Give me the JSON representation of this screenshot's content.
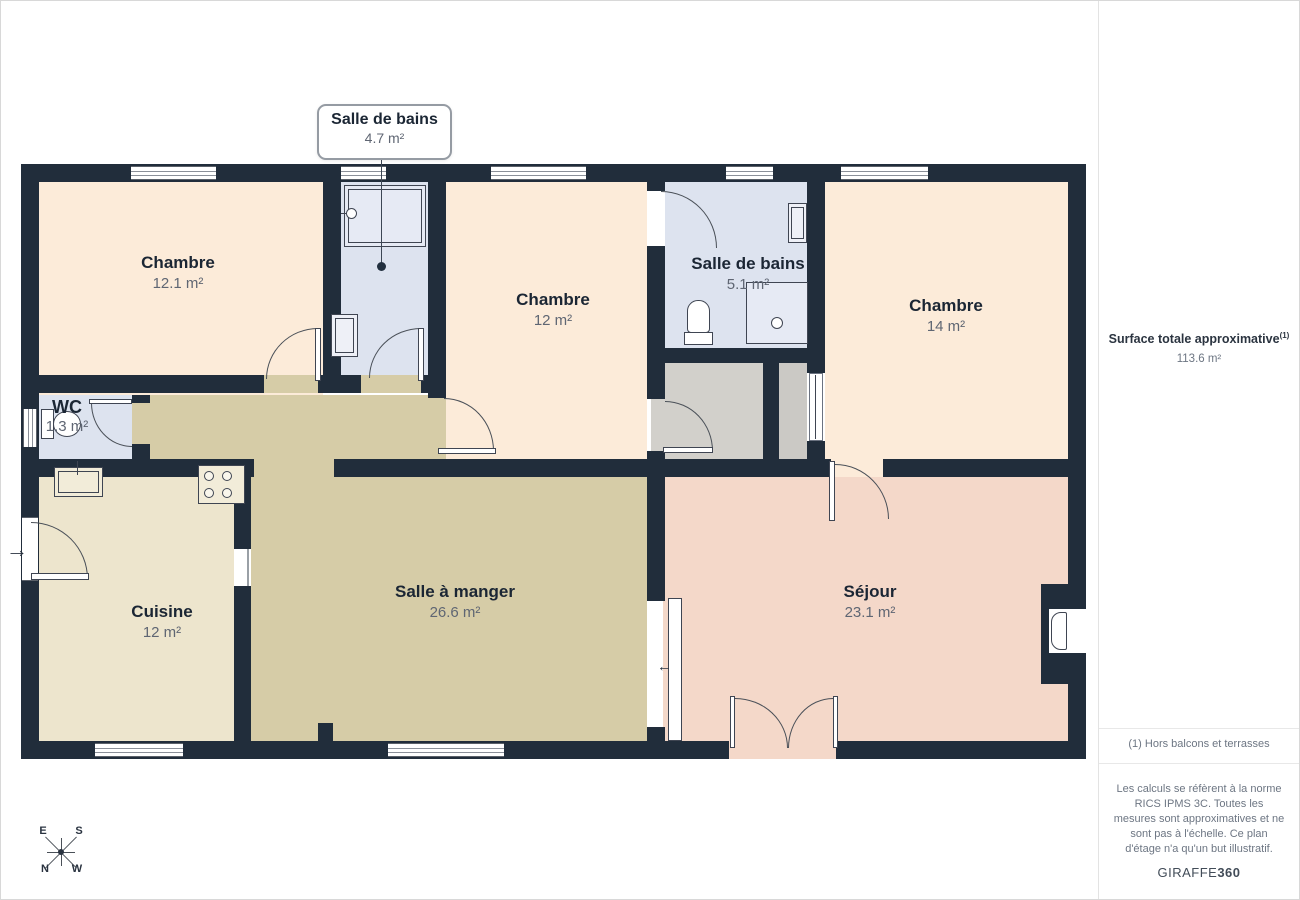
{
  "plan": {
    "callout": {
      "name": "Salle de bains",
      "area": "4.7 m²"
    },
    "rooms": [
      {
        "id": "chambre-1",
        "name": "Chambre",
        "area": "12.1 m²"
      },
      {
        "id": "chambre-2",
        "name": "Chambre",
        "area": "12 m²"
      },
      {
        "id": "salle-de-bains-2",
        "name": "Salle de bains",
        "area": "5.1 m²"
      },
      {
        "id": "chambre-3",
        "name": "Chambre",
        "area": "14 m²"
      },
      {
        "id": "wc",
        "name": "WC",
        "area": "1.3 m²"
      },
      {
        "id": "cuisine",
        "name": "Cuisine",
        "area": "12 m²"
      },
      {
        "id": "salle-a-manger",
        "name": "Salle à manger",
        "area": "26.6 m²"
      },
      {
        "id": "sejour",
        "name": "Séjour",
        "area": "23.1 m²"
      }
    ],
    "compass": {
      "e": "E",
      "s": "S",
      "n": "N",
      "w": "W"
    }
  },
  "sidebar": {
    "total_label": "Surface totale approximative",
    "total_marker": "(1)",
    "total_value": "113.6 m²",
    "footnote": "(1) Hors balcons et terrasses",
    "disclaimer": "Les calculs se réfèrent à la norme RICS IPMS 3C. Toutes les mesures sont approximatives et ne sont pas à l'échelle. Ce plan d'étage n'a qu'un but illustratif.",
    "brand": {
      "name": "GIRAFFE",
      "suffix": "360"
    }
  },
  "colors": {
    "wall": "#212d3b",
    "bedroom": "#fcebd9",
    "bathroom": "#dde3ef",
    "hall_dining": "#d6cca7",
    "kitchen": "#ede5cd",
    "living": "#f4d8c9",
    "closet": "#d2d0cb"
  }
}
